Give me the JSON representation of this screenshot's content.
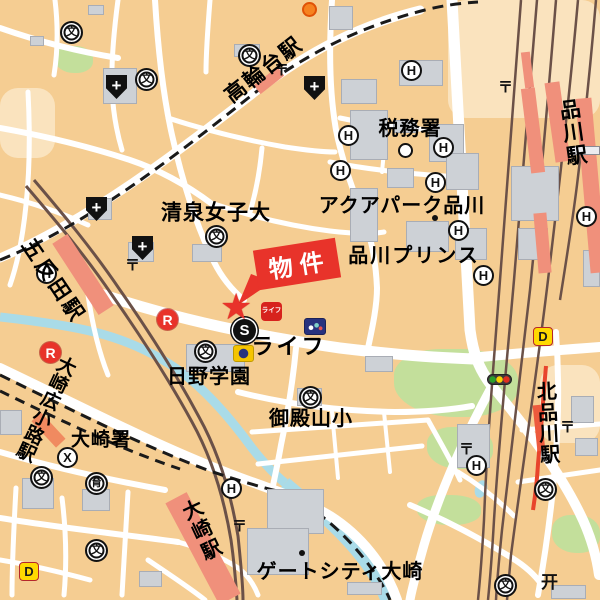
{
  "map_colors": {
    "background": "#F5CD92",
    "road": "#FFFFFF",
    "building": "#CDD1D6",
    "park": "#C3DF9B",
    "water": "#A9DBE8",
    "rail": "#6B5148",
    "station": "#F0907B",
    "accent_red": "#E8332A",
    "dennys_yellow": "#FFD900"
  },
  "callout": {
    "label": "物件",
    "star": "★"
  },
  "stations": {
    "takanawadai": "高輪台駅",
    "gotanda": "五反田駅",
    "osaki_hirokoji": "大崎広小路駅",
    "osaki": "大崎駅",
    "shinagawa": "品川駅",
    "kita_shinagawa": "北品川駅"
  },
  "places": {
    "seisen": "清泉女子大",
    "zeimusho": "税務署",
    "aqua_park": "アクアパーク品川",
    "prince": "品川プリンス",
    "life": "ライフ",
    "hino": "日野学園",
    "gotenyama": "御殿山小",
    "osaki_police": "大崎署",
    "gatecity": "ゲートシティ大崎"
  },
  "icons": {
    "school": "文",
    "hotel": "H",
    "hospital": "+",
    "post": "〒",
    "police": "X",
    "subway": "S",
    "restaurant": "R",
    "nursery": "育",
    "dennys": "D",
    "torii": "开",
    "life_logo": "ライフ"
  }
}
